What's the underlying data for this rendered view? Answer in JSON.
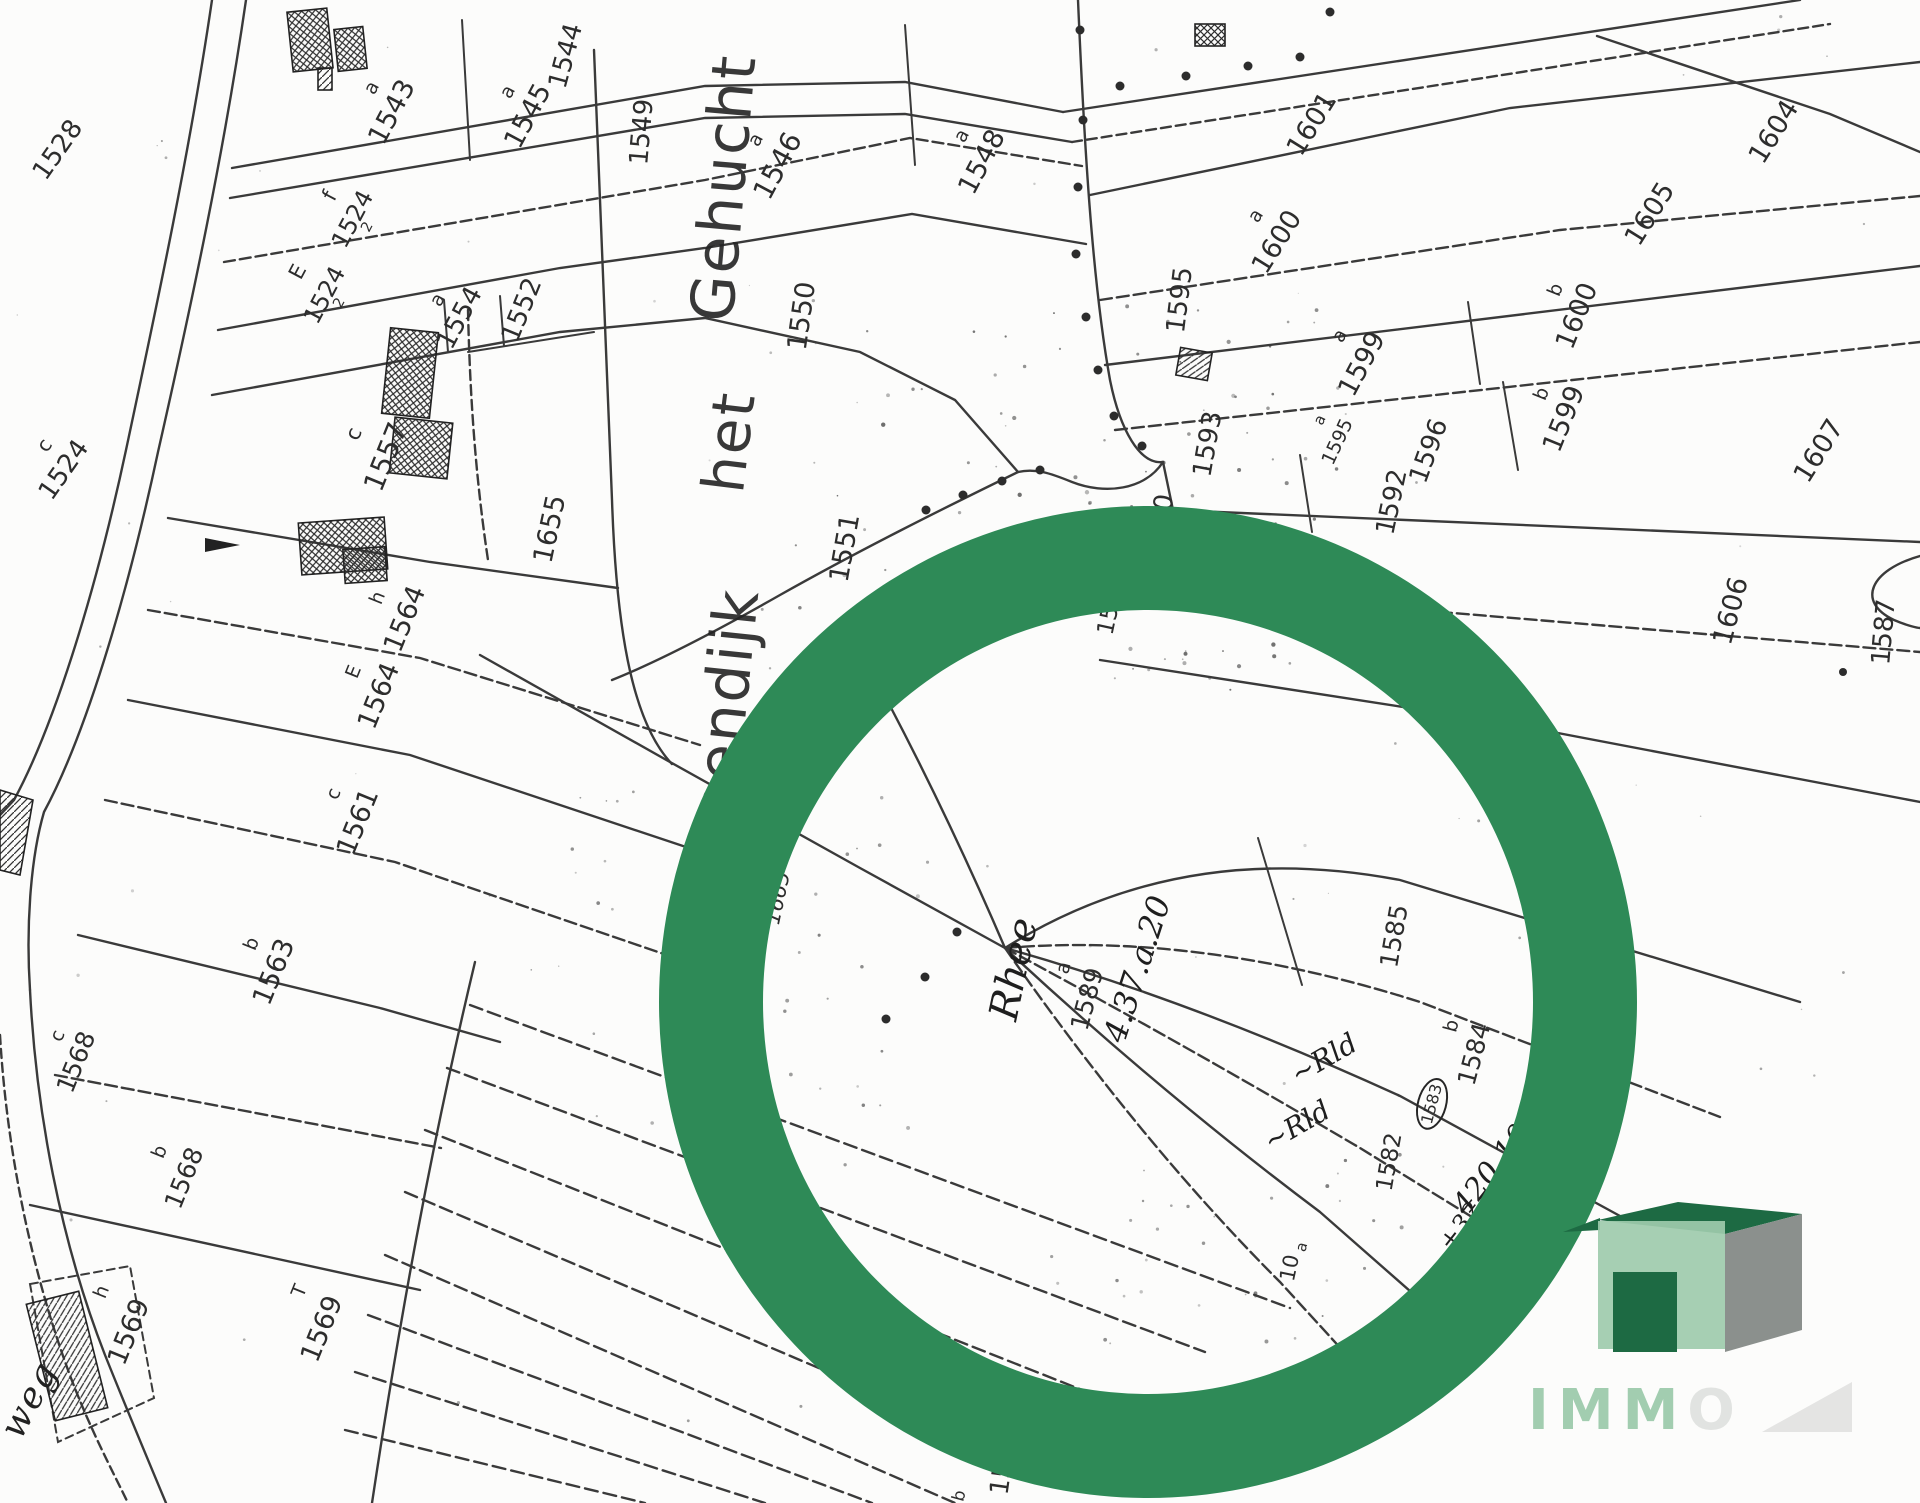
{
  "map": {
    "big_text": {
      "w1": "Genendijk",
      "w2": "het",
      "w3": "Gehucht"
    },
    "watermark": {
      "visible": "IMM",
      "faint": "O"
    },
    "colors": {
      "ring": "#2e8a57",
      "ink": "#3a3a3a",
      "wm_front": "#9ecbad",
      "wm_top": "#1d6a43",
      "wm_side": "#8b908d",
      "wm_door": "#1d6a43",
      "wm_text": "#9ecbad"
    },
    "labels": [
      {
        "t": "1528",
        "x": 58,
        "y": 150,
        "r": -55,
        "s": 26,
        "k": "num"
      },
      {
        "t": "c",
        "x": 44,
        "y": 445,
        "r": -55,
        "s": 20,
        "k": "let"
      },
      {
        "t": "1524",
        "x": 64,
        "y": 470,
        "r": -55,
        "s": 26,
        "k": "num"
      },
      {
        "t": "a",
        "x": 372,
        "y": 88,
        "r": -62,
        "s": 19,
        "k": "let"
      },
      {
        "t": "1543",
        "x": 392,
        "y": 112,
        "r": -62,
        "s": 27,
        "k": "num"
      },
      {
        "t": "1544",
        "x": 566,
        "y": 56,
        "r": -75,
        "s": 26,
        "k": "num"
      },
      {
        "t": "a",
        "x": 508,
        "y": 92,
        "r": -62,
        "s": 19,
        "k": "let"
      },
      {
        "t": "1545",
        "x": 528,
        "y": 116,
        "r": -62,
        "s": 27,
        "k": "num"
      },
      {
        "t": "1549",
        "x": 642,
        "y": 132,
        "r": -85,
        "s": 26,
        "k": "num"
      },
      {
        "t": "f",
        "x": 330,
        "y": 196,
        "r": -62,
        "s": 21,
        "k": "let"
      },
      {
        "t": "1524",
        "x": 358,
        "y": 222,
        "r": -62,
        "s": 24,
        "k": "frac",
        "f2": "2"
      },
      {
        "t": "E",
        "x": 298,
        "y": 272,
        "r": -62,
        "s": 21,
        "k": "let"
      },
      {
        "t": "1524",
        "x": 330,
        "y": 298,
        "r": -62,
        "s": 24,
        "k": "frac",
        "f2": "2"
      },
      {
        "t": "a",
        "x": 438,
        "y": 300,
        "r": -62,
        "s": 19,
        "k": "let"
      },
      {
        "t": "1554",
        "x": 460,
        "y": 318,
        "r": -62,
        "s": 26,
        "k": "num"
      },
      {
        "t": "1552",
        "x": 522,
        "y": 310,
        "r": -68,
        "s": 26,
        "k": "num"
      },
      {
        "t": "a",
        "x": 756,
        "y": 140,
        "r": -62,
        "s": 19,
        "k": "let"
      },
      {
        "t": "1546",
        "x": 778,
        "y": 166,
        "r": -62,
        "s": 28,
        "k": "num"
      },
      {
        "t": "a",
        "x": 962,
        "y": 136,
        "r": -62,
        "s": 19,
        "k": "let"
      },
      {
        "t": "1548",
        "x": 982,
        "y": 162,
        "r": -62,
        "s": 27,
        "k": "num"
      },
      {
        "t": "1550",
        "x": 802,
        "y": 316,
        "r": -82,
        "s": 27,
        "k": "num"
      },
      {
        "t": "1551",
        "x": 845,
        "y": 548,
        "r": -80,
        "s": 27,
        "k": "num"
      },
      {
        "t": "1601",
        "x": 1312,
        "y": 124,
        "r": -58,
        "s": 27,
        "k": "num"
      },
      {
        "t": "a",
        "x": 1256,
        "y": 216,
        "r": -58,
        "s": 19,
        "k": "let"
      },
      {
        "t": "1600",
        "x": 1277,
        "y": 242,
        "r": -58,
        "s": 27,
        "k": "num"
      },
      {
        "t": "1604",
        "x": 1774,
        "y": 132,
        "r": -58,
        "s": 27,
        "k": "num"
      },
      {
        "t": "1605",
        "x": 1650,
        "y": 214,
        "r": -58,
        "s": 27,
        "k": "num"
      },
      {
        "t": "1595",
        "x": 1180,
        "y": 300,
        "r": -83,
        "s": 26,
        "k": "num"
      },
      {
        "t": "a",
        "x": 1340,
        "y": 336,
        "r": -62,
        "s": 19,
        "k": "let"
      },
      {
        "t": "1599",
        "x": 1362,
        "y": 364,
        "r": -62,
        "s": 27,
        "k": "num"
      },
      {
        "t": "b",
        "x": 1556,
        "y": 290,
        "r": -68,
        "s": 19,
        "k": "let"
      },
      {
        "t": "1600",
        "x": 1577,
        "y": 316,
        "r": -68,
        "s": 27,
        "k": "num"
      },
      {
        "t": "b",
        "x": 1542,
        "y": 394,
        "r": -68,
        "s": 19,
        "k": "let"
      },
      {
        "t": "1599",
        "x": 1564,
        "y": 419,
        "r": -68,
        "s": 27,
        "k": "num"
      },
      {
        "t": "a",
        "x": 1320,
        "y": 420,
        "r": -65,
        "s": 15,
        "k": "let"
      },
      {
        "t": "1595",
        "x": 1338,
        "y": 442,
        "r": -65,
        "s": 19,
        "k": "num"
      },
      {
        "t": "1596",
        "x": 1429,
        "y": 451,
        "r": -70,
        "s": 26,
        "k": "num"
      },
      {
        "t": "1607",
        "x": 1819,
        "y": 451,
        "r": -58,
        "s": 27,
        "k": "num"
      },
      {
        "t": "1606",
        "x": 1731,
        "y": 611,
        "r": -75,
        "s": 27,
        "k": "num"
      },
      {
        "t": "1592",
        "x": 1392,
        "y": 502,
        "r": -78,
        "s": 26,
        "k": "num"
      },
      {
        "t": "1593",
        "x": 1208,
        "y": 444,
        "r": -80,
        "s": 26,
        "k": "num"
      },
      {
        "t": "1590",
        "x": 1160,
        "y": 527,
        "r": -80,
        "s": 26,
        "k": "num"
      },
      {
        "t": "1591",
        "x": 1350,
        "y": 599,
        "r": -80,
        "s": 26,
        "k": "num"
      },
      {
        "t": "1589",
        "x": 1112,
        "y": 606,
        "r": -78,
        "s": 23,
        "k": "num"
      },
      {
        "t": "1587",
        "x": 1884,
        "y": 632,
        "r": -85,
        "s": 26,
        "k": "num"
      },
      {
        "t": "c",
        "x": 354,
        "y": 434,
        "r": -68,
        "s": 21,
        "k": "let"
      },
      {
        "t": "1557",
        "x": 386,
        "y": 457,
        "r": -68,
        "s": 28,
        "k": "num"
      },
      {
        "t": "1655",
        "x": 550,
        "y": 529,
        "r": -78,
        "s": 27,
        "k": "num"
      },
      {
        "t": "1665",
        "x": 778,
        "y": 898,
        "r": -78,
        "s": 21,
        "k": "num italic"
      },
      {
        "t": "h",
        "x": 378,
        "y": 598,
        "r": -68,
        "s": 19,
        "k": "let"
      },
      {
        "t": "1564",
        "x": 405,
        "y": 619,
        "r": -68,
        "s": 27,
        "k": "num"
      },
      {
        "t": "E",
        "x": 354,
        "y": 672,
        "r": -68,
        "s": 19,
        "k": "let"
      },
      {
        "t": "1564",
        "x": 379,
        "y": 696,
        "r": -68,
        "s": 27,
        "k": "num"
      },
      {
        "t": "c",
        "x": 334,
        "y": 794,
        "r": -68,
        "s": 19,
        "k": "let"
      },
      {
        "t": "1561",
        "x": 358,
        "y": 822,
        "r": -68,
        "s": 27,
        "k": "num"
      },
      {
        "t": "b",
        "x": 252,
        "y": 944,
        "r": -68,
        "s": 19,
        "k": "let"
      },
      {
        "t": "1563",
        "x": 274,
        "y": 972,
        "r": -68,
        "s": 27,
        "k": "num"
      },
      {
        "t": "c",
        "x": 58,
        "y": 1036,
        "r": -68,
        "s": 19,
        "k": "let"
      },
      {
        "t": "1568",
        "x": 76,
        "y": 1062,
        "r": -68,
        "s": 25,
        "k": "num"
      },
      {
        "t": "b",
        "x": 160,
        "y": 1152,
        "r": -68,
        "s": 19,
        "k": "let"
      },
      {
        "t": "1568",
        "x": 184,
        "y": 1178,
        "r": -68,
        "s": 25,
        "k": "num"
      },
      {
        "t": "h",
        "x": 102,
        "y": 1292,
        "r": -68,
        "s": 19,
        "k": "let"
      },
      {
        "t": "1569",
        "x": 129,
        "y": 1332,
        "r": -68,
        "s": 27,
        "k": "num"
      },
      {
        "t": "T",
        "x": 300,
        "y": 1291,
        "r": -68,
        "s": 19,
        "k": "let"
      },
      {
        "t": "1569",
        "x": 322,
        "y": 1329,
        "r": -68,
        "s": 27,
        "k": "num"
      },
      {
        "t": "weg",
        "x": 30,
        "y": 1400,
        "r": -62,
        "s": 36,
        "k": "road"
      },
      {
        "t": "1577",
        "x": 1004,
        "y": 1462,
        "r": -82,
        "s": 26,
        "k": "num"
      },
      {
        "t": "b",
        "x": 960,
        "y": 1496,
        "r": -75,
        "s": 17,
        "k": "let"
      },
      {
        "t": "1585",
        "x": 1394,
        "y": 936,
        "r": -80,
        "s": 25,
        "k": "num"
      },
      {
        "t": "b",
        "x": 1452,
        "y": 1026,
        "r": -75,
        "s": 19,
        "k": "let"
      },
      {
        "t": "1584",
        "x": 1474,
        "y": 1054,
        "r": -75,
        "s": 25,
        "k": "num"
      },
      {
        "t": "1583",
        "x": 1432,
        "y": 1104,
        "r": -75,
        "s": 16,
        "k": "circ"
      },
      {
        "t": "1582",
        "x": 1390,
        "y": 1162,
        "r": -80,
        "s": 23,
        "k": "num"
      },
      {
        "t": "a",
        "x": 1064,
        "y": 968,
        "r": -75,
        "s": 19,
        "k": "let"
      },
      {
        "t": "1589",
        "x": 1087,
        "y": 999,
        "r": -75,
        "s": 25,
        "k": "num"
      },
      {
        "t": "a",
        "x": 1302,
        "y": 1247,
        "r": -75,
        "s": 15,
        "k": "let"
      },
      {
        "t": "10",
        "x": 1290,
        "y": 1268,
        "r": -78,
        "s": 21,
        "k": "num"
      },
      {
        "t": "Rhee",
        "x": 1014,
        "y": 969,
        "r": -78,
        "s": 40,
        "k": "hw"
      },
      {
        "t": "4.37.a.20",
        "x": 1137,
        "y": 969,
        "r": -72,
        "s": 32,
        "k": "hw"
      },
      {
        "t": "~Rld",
        "x": 1324,
        "y": 1059,
        "r": -30,
        "s": 28,
        "k": "hw"
      },
      {
        "t": "~Rld",
        "x": 1297,
        "y": 1126,
        "r": -30,
        "s": 28,
        "k": "hw"
      },
      {
        "t": "420,10",
        "x": 1492,
        "y": 1170,
        "r": -52,
        "s": 30,
        "k": "hw"
      },
      {
        "t": "+32",
        "x": 1460,
        "y": 1226,
        "r": -52,
        "s": 25,
        "k": "hw"
      }
    ]
  }
}
